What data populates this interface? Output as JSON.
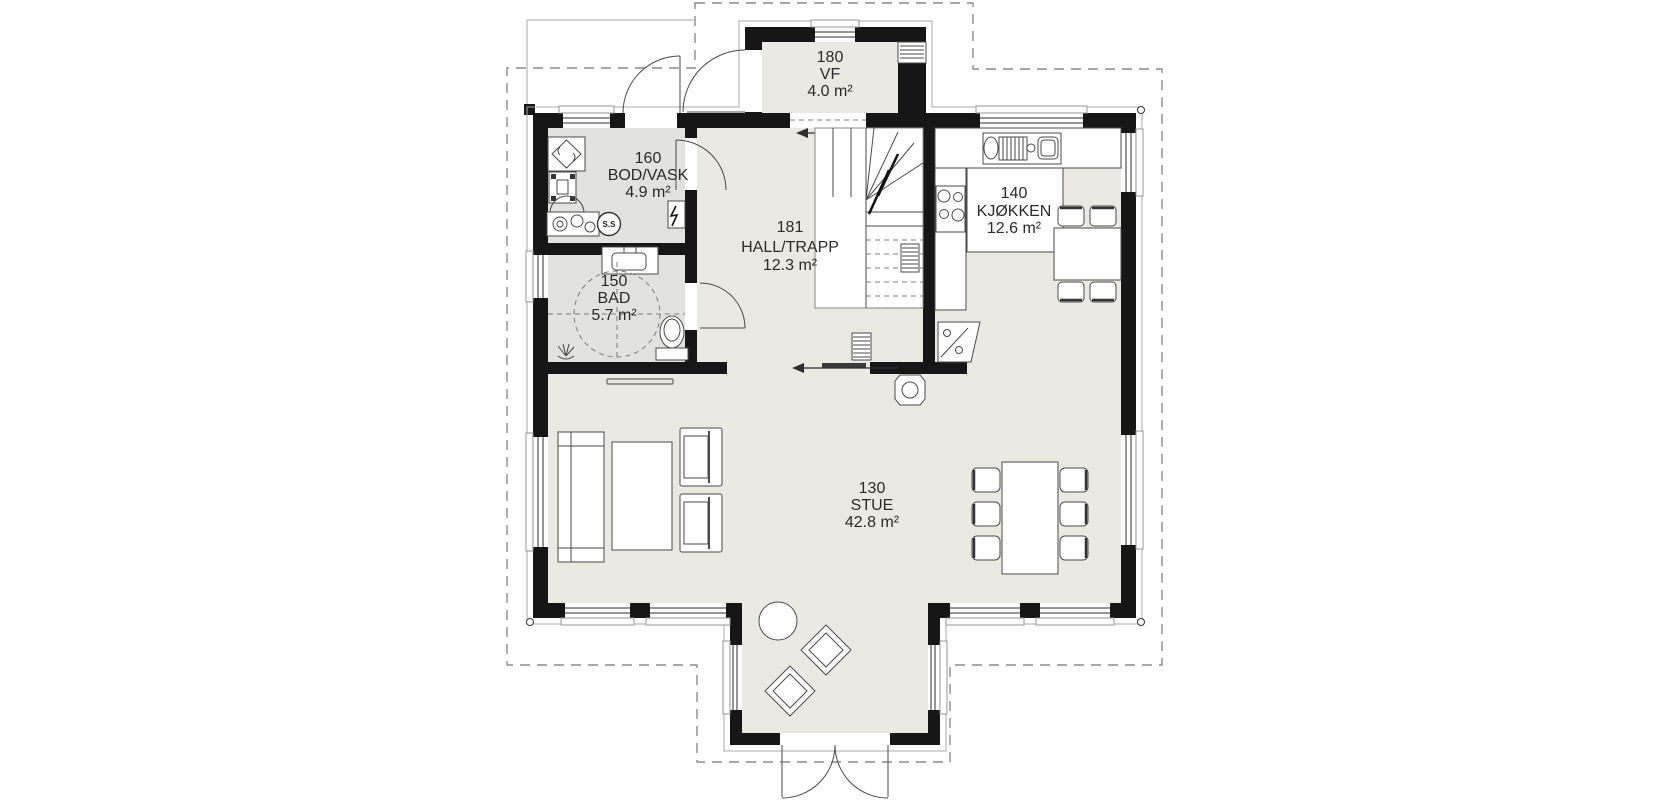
{
  "plan": {
    "rooms": [
      {
        "number": "180",
        "name": "VF",
        "area": "4.0 m²"
      },
      {
        "number": "160",
        "name": "BOD/VASK",
        "area": "4.9 m²"
      },
      {
        "number": "150",
        "name": "BAD",
        "area": "5.7 m²"
      },
      {
        "number": "181",
        "name": "HALL/TRAPP",
        "area": "12.3 m²"
      },
      {
        "number": "140",
        "name": "KJØKKEN",
        "area": "12.6 m²"
      },
      {
        "number": "130",
        "name": "STUE",
        "area": "42.8 m²"
      }
    ],
    "annotations": {
      "sink_label": "S.S"
    },
    "colors": {
      "wall": "#161616",
      "floor_main": "#ebeae2",
      "floor_wet": "#e2e2e0",
      "facade_outline": "#a8a8a8",
      "roof_overhang_dash": "#8c8c8c",
      "background": "#ffffff"
    }
  }
}
